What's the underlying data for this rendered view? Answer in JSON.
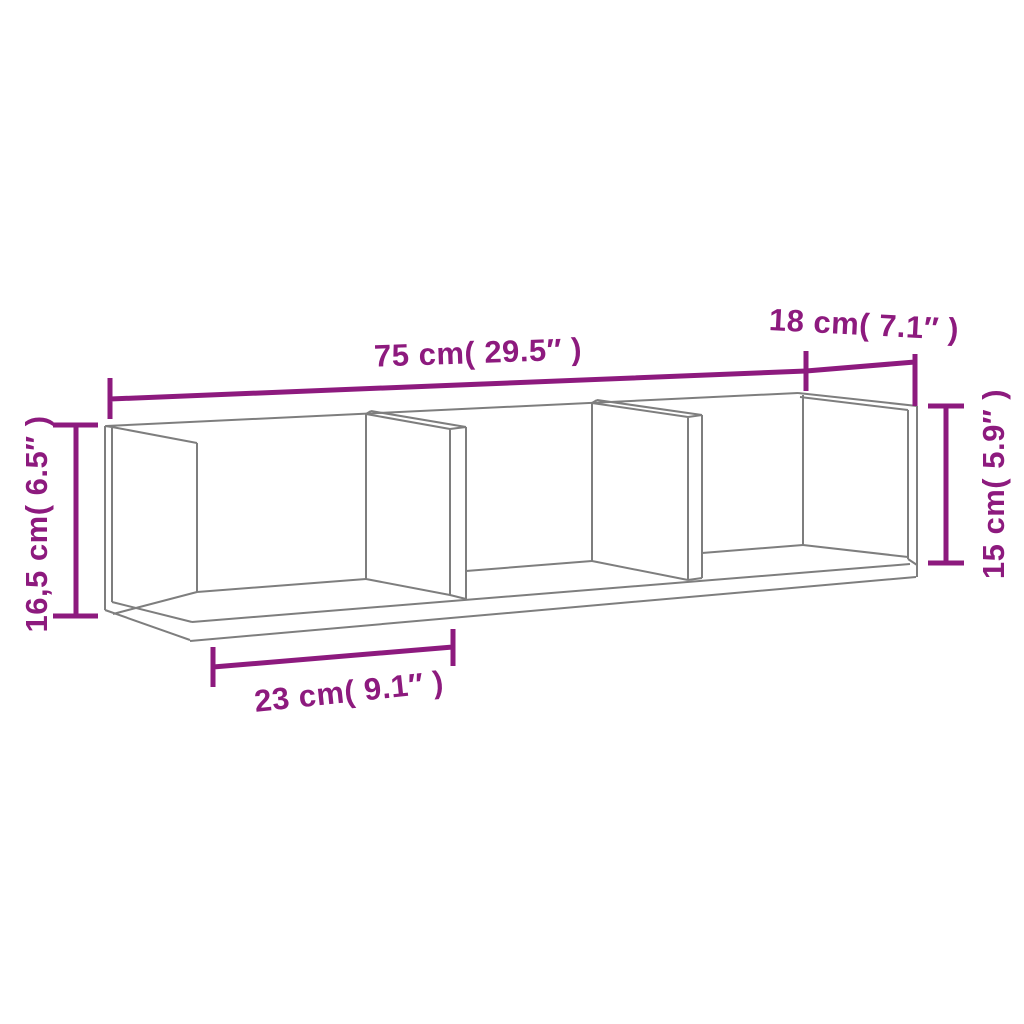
{
  "diagram": {
    "type": "product-dimension-diagram",
    "subject": "wall-mounted shelf cabinet with 3 open compartments, perspective line drawing",
    "colors": {
      "background": "#ffffff",
      "shelf_outline": "#7e7e7e",
      "dimension": "#8d1a7e"
    },
    "dimensions": {
      "width": "75 cm( 29.5″ )",
      "depth": "18 cm( 7.1″ )",
      "height_left": "16,5 cm( 6.5″ )",
      "height_right": "15 cm( 5.9″ )",
      "compartment_width": "23 cm( 9.1″ )"
    }
  }
}
